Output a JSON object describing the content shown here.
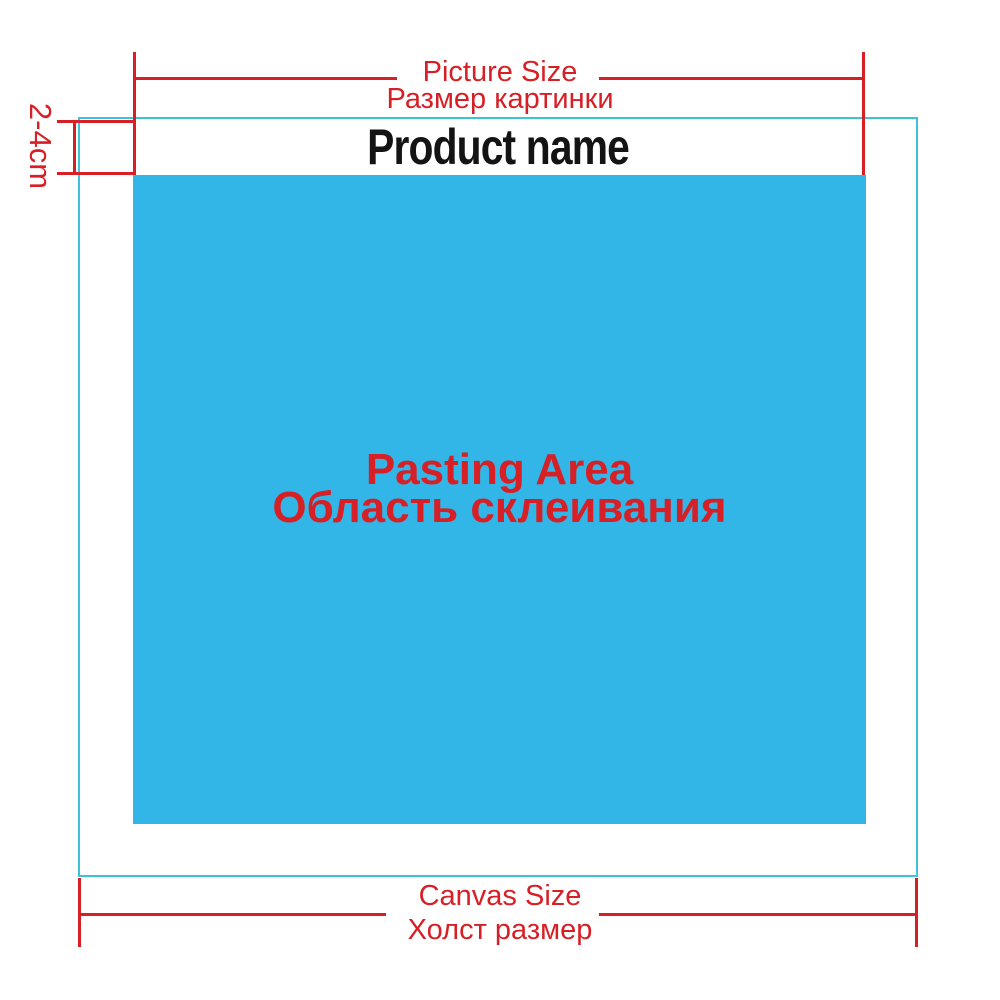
{
  "colors": {
    "red": "#d71f26",
    "blue_fill": "#31b6e7",
    "cyan_border": "#3cc3da",
    "black": "#141414",
    "background": "#ffffff"
  },
  "product": {
    "name": "Product name"
  },
  "top_dimension": {
    "label_en": "Picture Size",
    "label_ru": "Размер картинки"
  },
  "left_dimension": {
    "label": "2-4cm"
  },
  "pasting_area": {
    "label_en": "Pasting Area",
    "label_ru": "Область склеивания"
  },
  "bottom_dimension": {
    "label_en": "Canvas Size",
    "label_ru": "Холст размер"
  }
}
